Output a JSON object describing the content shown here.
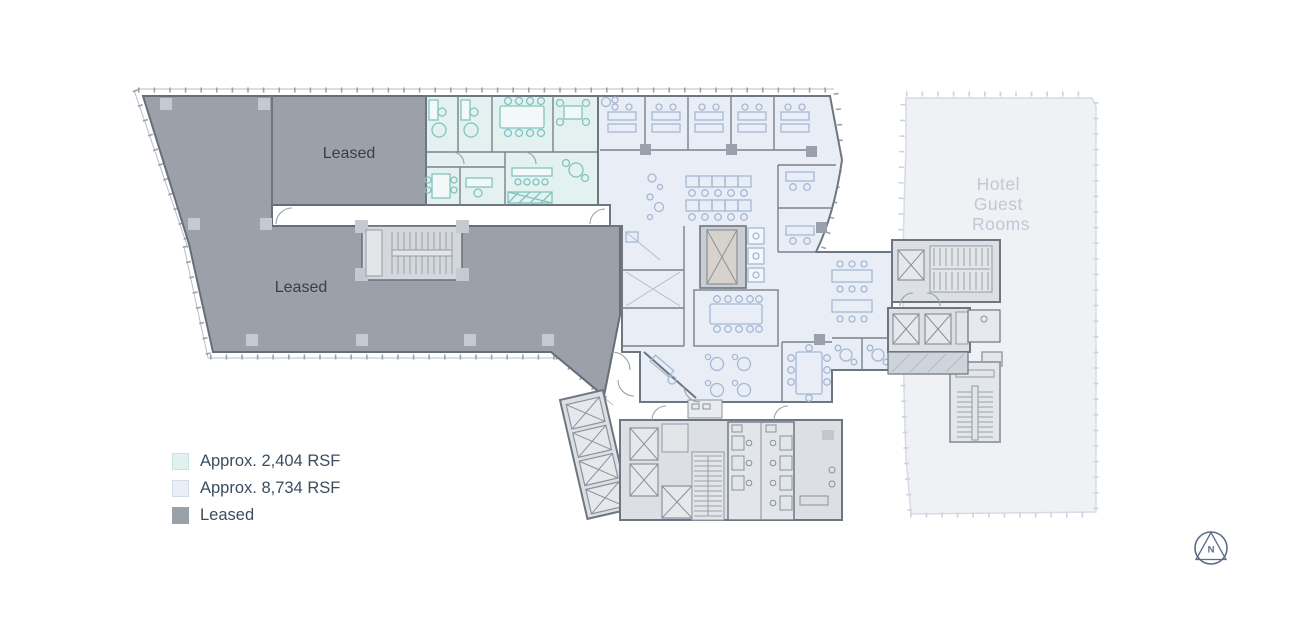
{
  "floorplan": {
    "labels": {
      "leased_upper": "Leased",
      "leased_lower": "Leased",
      "hotel_lines": [
        "Hotel",
        "Guest",
        "Rooms"
      ]
    },
    "colors": {
      "leased_fill": "#9ba0a9",
      "unit_2404_fill": "#e3f1f0",
      "unit_2404_accent": "#82c3bf",
      "unit_8734_fill": "#e9eef6",
      "unit_8734_accent": "#a4b8d4",
      "hotel_fill": "#eff1f5",
      "hotel_text": "#bfc9d5",
      "wall": "#6e7681",
      "label_text": "#3a3f47"
    }
  },
  "legend": {
    "items": [
      {
        "label": "Approx. 2,404 RSF",
        "swatch_color": "#e1f1f0"
      },
      {
        "label": "Approx. 8,734 RSF",
        "swatch_color": "#e9eef7"
      },
      {
        "label": "Leased",
        "swatch_color": "#9aa0a8"
      }
    ]
  },
  "compass": {
    "label": "N",
    "color": "#5c6c88"
  }
}
